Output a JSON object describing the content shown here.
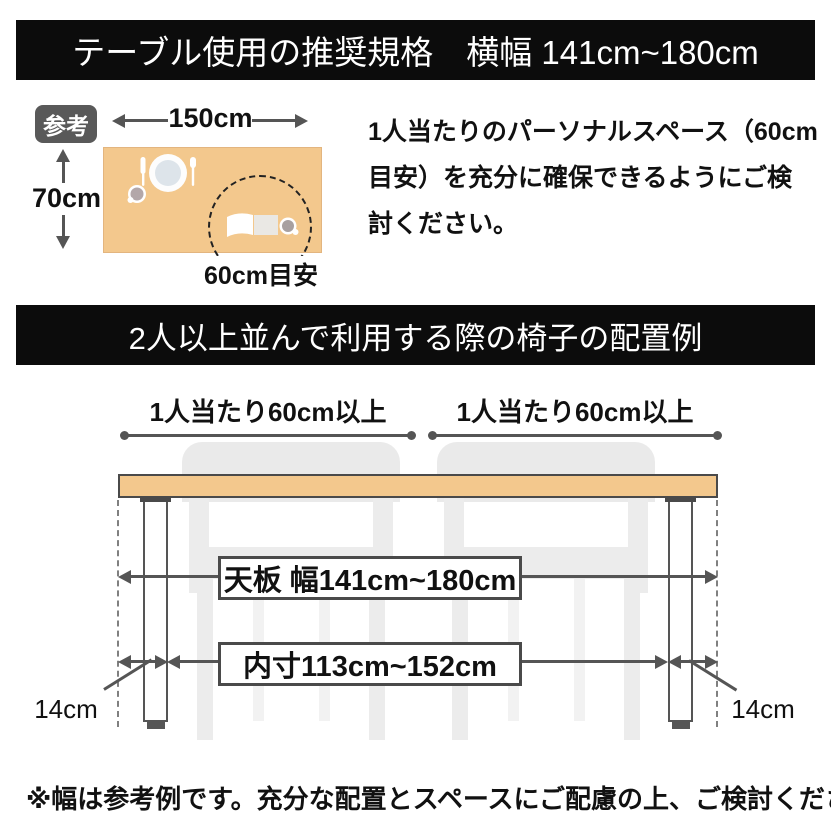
{
  "colors": {
    "banner_bg": "#0c0c0c",
    "banner_text": "#ffffff",
    "table_tan": "#f3c88d",
    "line_dark": "#555555",
    "border_dark": "#4a4a4a",
    "chair_gray": "#eaeaea",
    "badge_bg": "#595959"
  },
  "top_banner": {
    "title": "テーブル使用の推奨規格　横幅 141cm~180cm"
  },
  "reference": {
    "badge": "参考",
    "width": "150cm",
    "depth": "70cm",
    "personal_space": "60cm目安",
    "note_lines": [
      "1人当たりのパーソナルスペース（60cm",
      "目安）を充分に確保できるようにご検",
      "討ください。"
    ]
  },
  "middle_banner": {
    "title": "2人以上並んで利用する際の椅子の配置例"
  },
  "arrangement": {
    "per_person_left": "1人当たり60cm以上",
    "per_person_right": "1人当たり60cm以上",
    "tabletop_width": "天板 幅141cm~180cm",
    "inner_width": "内寸113cm~152cm",
    "leg_offset_left": "14cm",
    "leg_offset_right": "14cm"
  },
  "footnote": "※幅は参考例です。充分な配置とスペースにご配慮の上、ご検討ください。"
}
